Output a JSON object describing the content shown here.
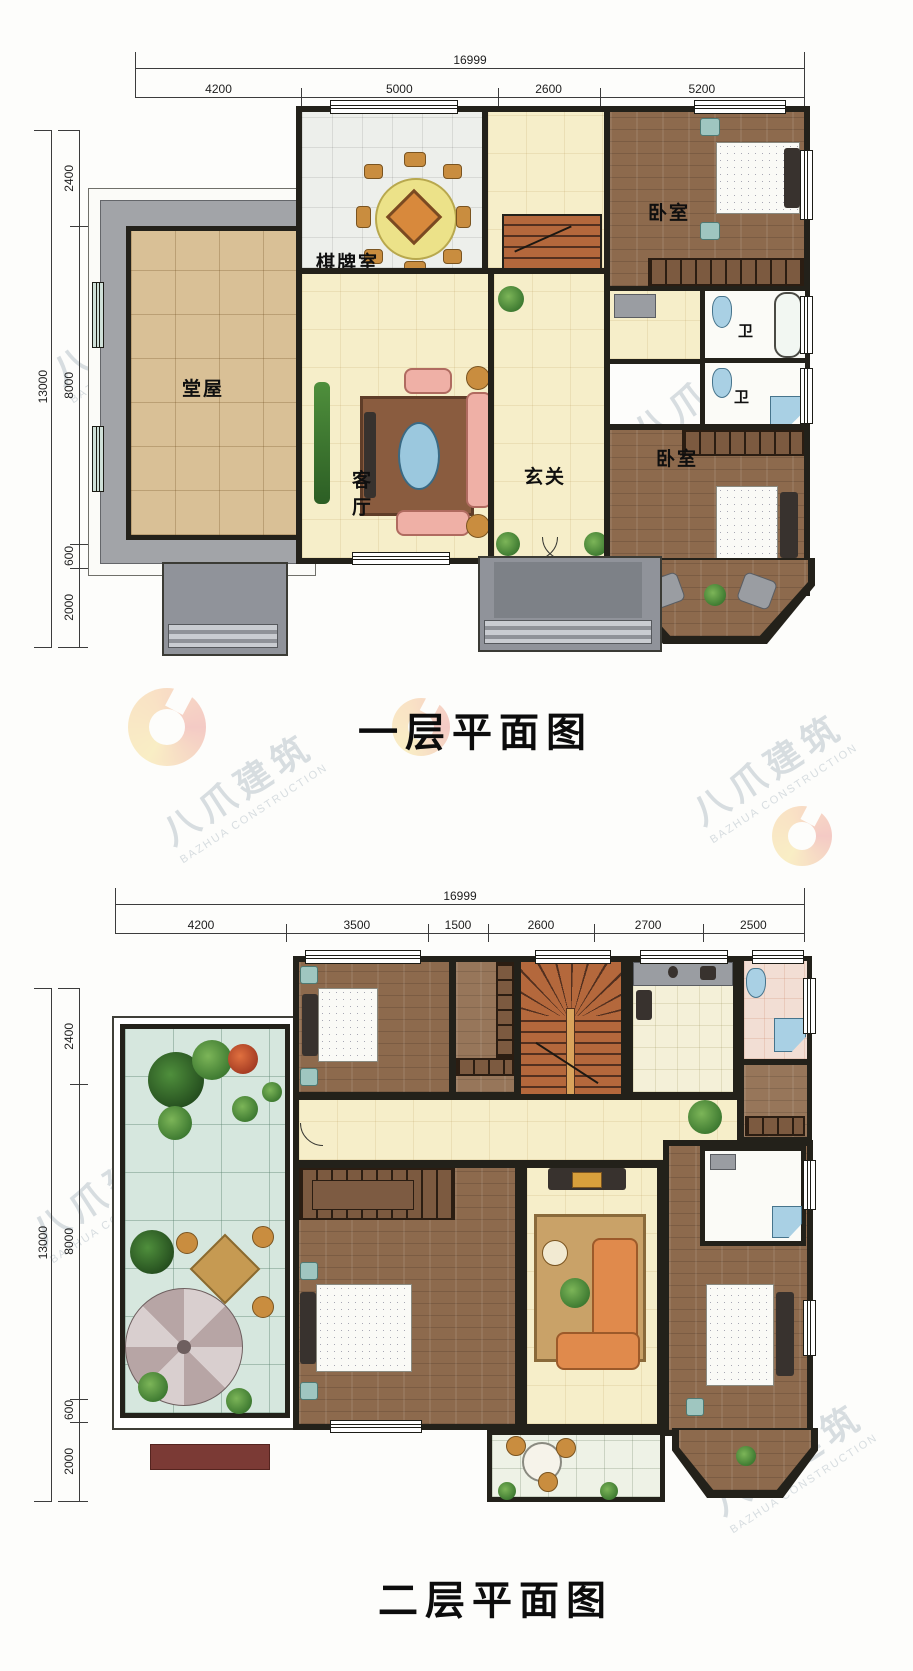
{
  "sheet": {
    "floor1_title": "一层平面图",
    "floor2_title": "二层平面图"
  },
  "watermark": {
    "cn": "八爪建筑",
    "en": "BAZHUA CONSTRUCTION"
  },
  "floor1": {
    "dims_top_total": "16999",
    "dims_top": [
      "4200",
      "5000",
      "2600",
      "5200"
    ],
    "dims_left_total": "13000",
    "dims_left": [
      "2400",
      "8000",
      "600",
      "2000"
    ],
    "rooms": {
      "game_room": "棋牌室",
      "bedroom_top": "卧室",
      "main_hall": "堂屋",
      "living": "客厅",
      "foyer": "玄关",
      "bedroom_bottom": "卧室",
      "bath1": "卫",
      "bath2": "卫"
    }
  },
  "floor2": {
    "dims_top_total": "16999",
    "dims_top": [
      "4200",
      "3500",
      "1500",
      "2600",
      "2700",
      "2500"
    ],
    "dims_left_total": "13000",
    "dims_left": [
      "2400",
      "8000",
      "600",
      "2000"
    ]
  },
  "colors": {
    "wall": "#23211a",
    "floor_yellow": "#f6eec9",
    "floor_wood": "#8d6a4d",
    "terrace_tile": "#d6e7de",
    "stair": "#b4683c",
    "porch_gray": "#90939a",
    "logo_accent": "#e98b2d"
  }
}
